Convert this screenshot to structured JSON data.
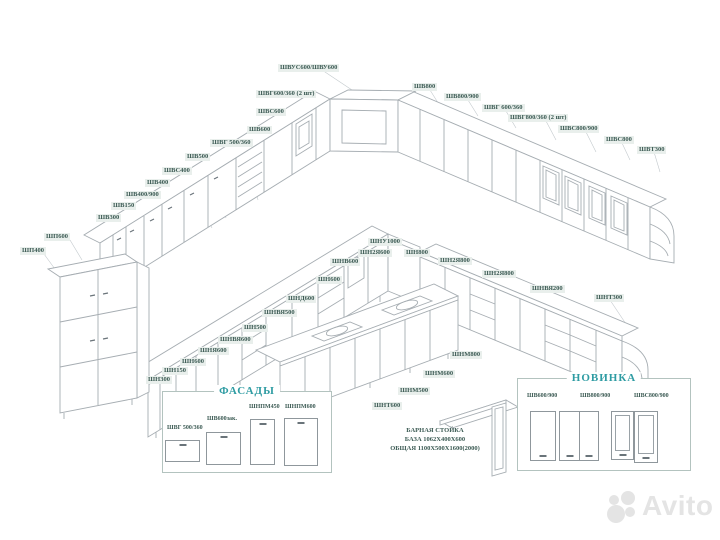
{
  "colors": {
    "label_text": "#3c5b54",
    "label_bg": "#e9efec",
    "heading": "#2f9ca3",
    "line": "#a6adb2",
    "watermark": "#e4e4e4"
  },
  "module_labels": [
    {
      "t": "ШВ300",
      "x": 96,
      "y": 214
    },
    {
      "t": "ШВ150",
      "x": 111,
      "y": 202
    },
    {
      "t": "ШВ400/900",
      "x": 124,
      "y": 191
    },
    {
      "t": "ШВ400",
      "x": 145,
      "y": 179
    },
    {
      "t": "ШВС400",
      "x": 162,
      "y": 167
    },
    {
      "t": "ШВ500",
      "x": 185,
      "y": 153
    },
    {
      "t": "ШВГ 500/360",
      "x": 210,
      "y": 139
    },
    {
      "t": "ШВ600",
      "x": 247,
      "y": 126
    },
    {
      "t": "ШВС600",
      "x": 256,
      "y": 108
    },
    {
      "t": "ШВГ600/360 (2 шт)",
      "x": 256,
      "y": 90
    },
    {
      "t": "ШВУС600/ШВУ600",
      "x": 278,
      "y": 64
    },
    {
      "t": "ШВ800",
      "x": 412,
      "y": 83
    },
    {
      "t": "ШВ800/900",
      "x": 444,
      "y": 93
    },
    {
      "t": "ШВГ 600/360",
      "x": 482,
      "y": 104
    },
    {
      "t": "ШВГ800/360 (2 шт)",
      "x": 508,
      "y": 114
    },
    {
      "t": "ШВС800/900",
      "x": 558,
      "y": 125
    },
    {
      "t": "ШВС800",
      "x": 604,
      "y": 136
    },
    {
      "t": "ШВТ300",
      "x": 637,
      "y": 146
    },
    {
      "t": "ШП600",
      "x": 44,
      "y": 233
    },
    {
      "t": "ШП400",
      "x": 20,
      "y": 247
    },
    {
      "t": "ШН300",
      "x": 146,
      "y": 376
    },
    {
      "t": "ШН150",
      "x": 162,
      "y": 367
    },
    {
      "t": "ШН600",
      "x": 180,
      "y": 358
    },
    {
      "t": "ШНЯ600",
      "x": 198,
      "y": 347
    },
    {
      "t": "ШНВЯ600",
      "x": 218,
      "y": 336
    },
    {
      "t": "ШН500",
      "x": 242,
      "y": 324
    },
    {
      "t": "ШНВЯ500",
      "x": 262,
      "y": 309
    },
    {
      "t": "ШНД600",
      "x": 286,
      "y": 295
    },
    {
      "t": "ШН600",
      "x": 316,
      "y": 276
    },
    {
      "t": "ШНВ600",
      "x": 330,
      "y": 258
    },
    {
      "t": "ШНУ1000",
      "x": 368,
      "y": 238
    },
    {
      "t": "ШН2Я600",
      "x": 358,
      "y": 249
    },
    {
      "t": "ШН800",
      "x": 404,
      "y": 249
    },
    {
      "t": "ШН2Я800",
      "x": 438,
      "y": 257
    },
    {
      "t": "ШН2Я800",
      "x": 482,
      "y": 270
    },
    {
      "t": "ШНВЯ200",
      "x": 530,
      "y": 285
    },
    {
      "t": "ШНТ300",
      "x": 594,
      "y": 294
    },
    {
      "t": "ШНМ800",
      "x": 450,
      "y": 351
    },
    {
      "t": "ШНМ600",
      "x": 423,
      "y": 370
    },
    {
      "t": "ШНМ500",
      "x": 398,
      "y": 387
    },
    {
      "t": "ШНТ600",
      "x": 372,
      "y": 402
    }
  ],
  "facades": {
    "title": "ФАСАДЫ",
    "items": [
      "ШВГ 500/360",
      "ШВ600зак.",
      "ШНПМ450",
      "ШНПМ600"
    ]
  },
  "novinka": {
    "title": "НОВИНКА",
    "items": [
      "ШВ600/900",
      "ШВ800/900",
      "ШВС800/900"
    ]
  },
  "bar_stand": {
    "lines": [
      "БАРНАЯ СТОЙКА",
      "БАЗА 1062Х400Х600",
      "ОБЩАЯ 1100Х500Х1600(2000)"
    ]
  },
  "watermark": {
    "brand": "Avito"
  }
}
